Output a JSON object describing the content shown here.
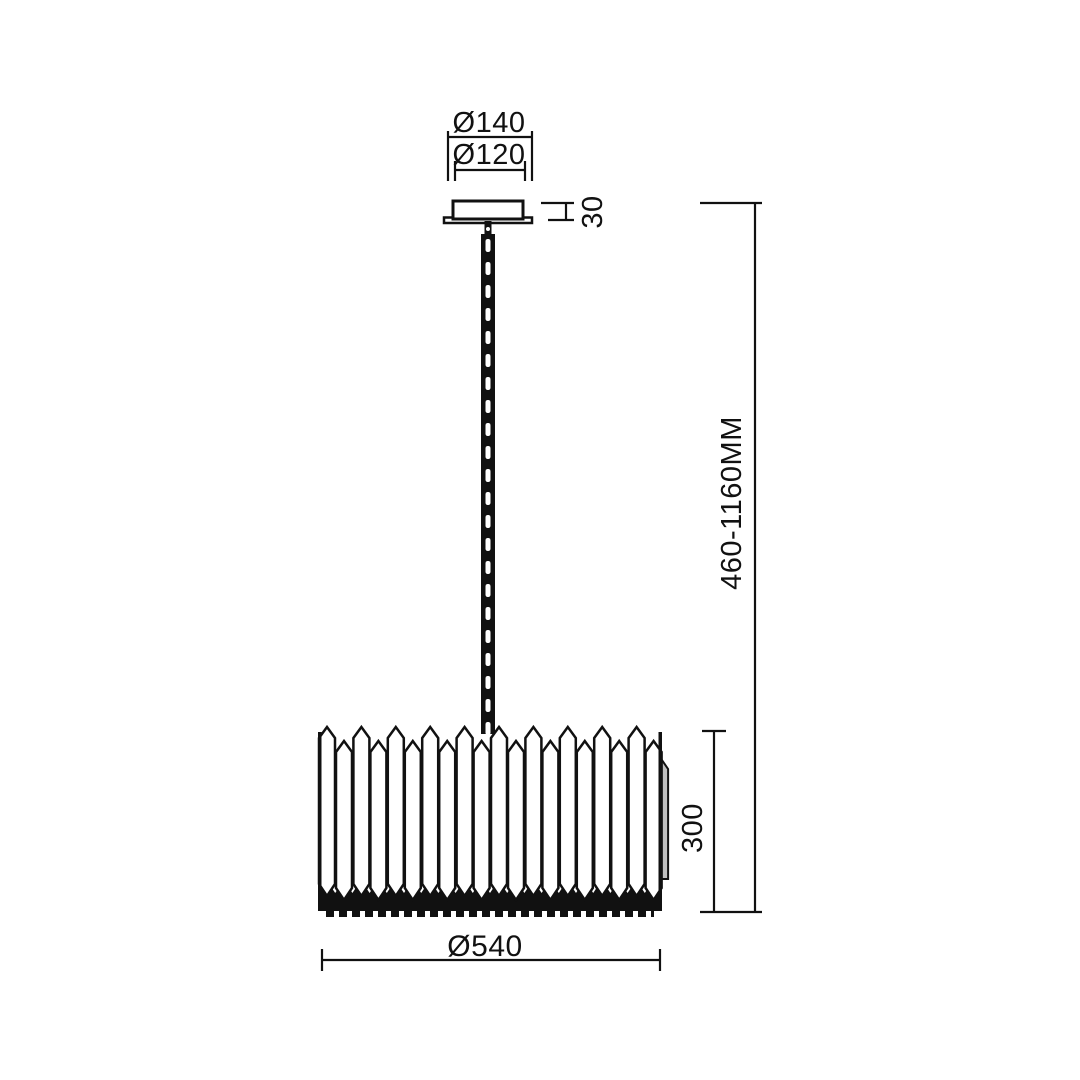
{
  "page": {
    "background": "#ffffff",
    "line_color": "#111111",
    "shade_back_fill": "#bfbfbf"
  },
  "drawing": {
    "type": "pendant-lamp-dimension-diagram",
    "labels": {
      "canopy_outer_diameter": "Ø140",
      "canopy_inner_diameter": "Ø120",
      "canopy_height": "30",
      "hanging_height_range": "460-1160MM",
      "shade_height": "300",
      "shade_diameter": "Ø540"
    }
  }
}
